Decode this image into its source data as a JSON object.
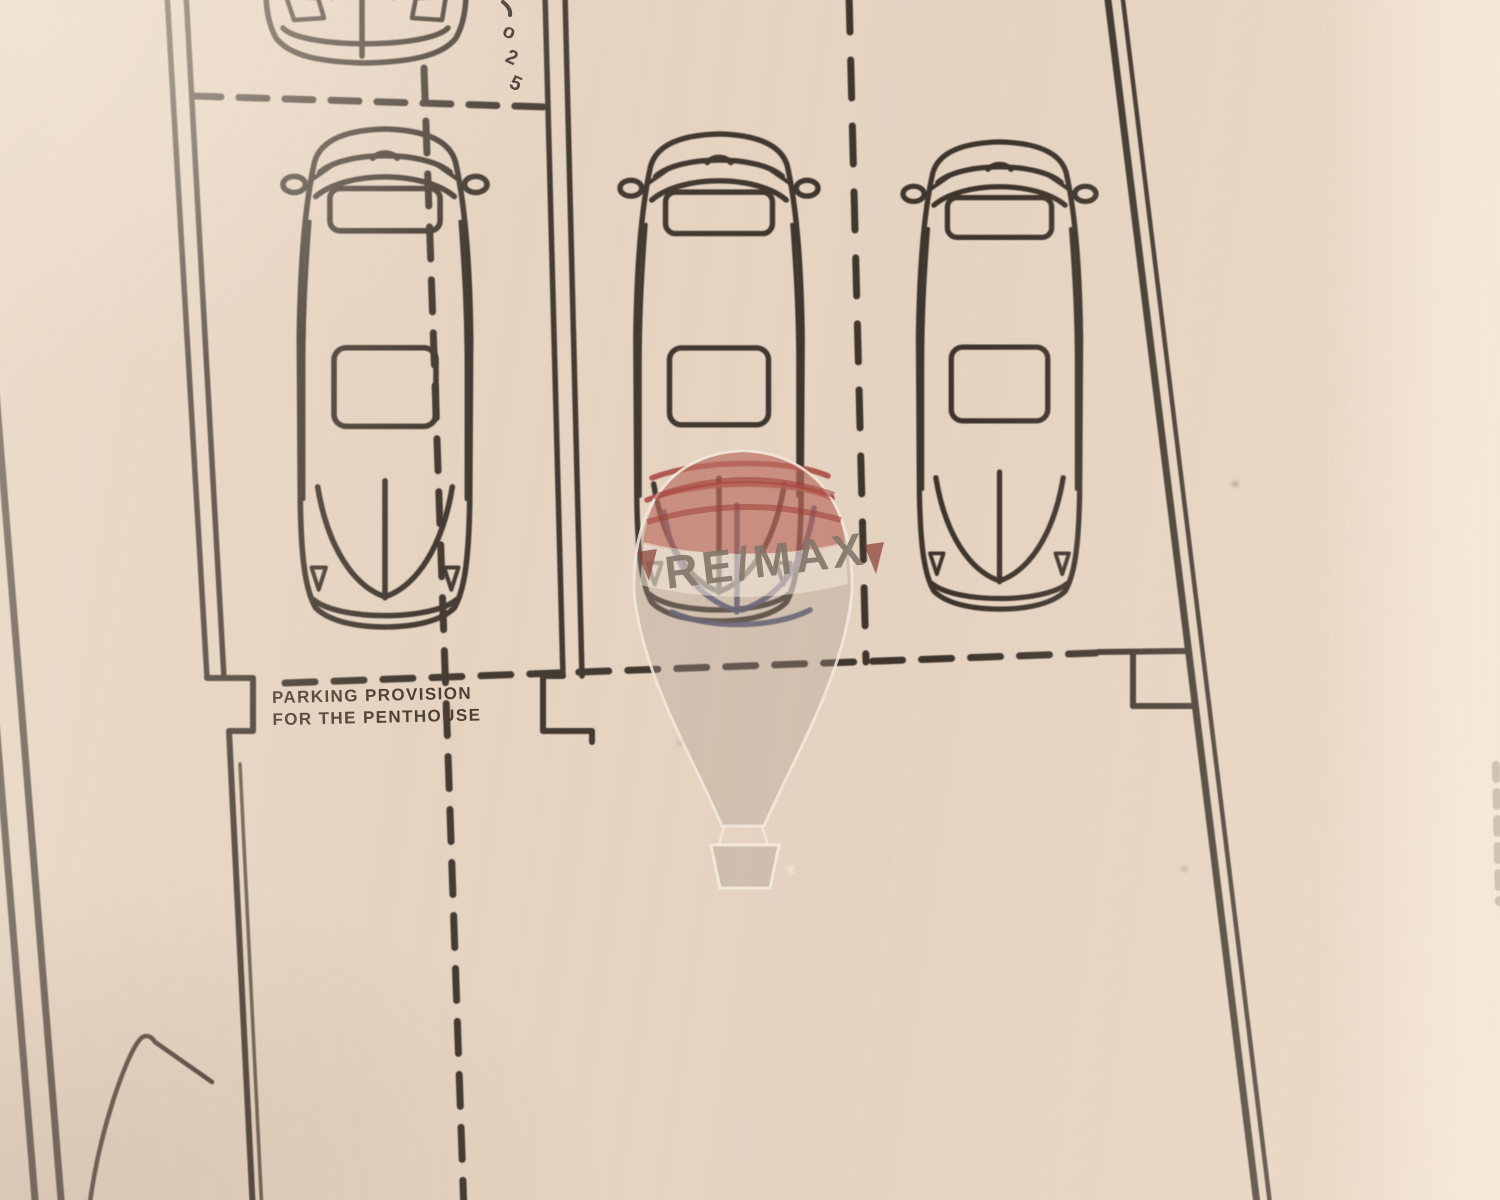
{
  "document": {
    "kind": "scanned architectural parking site plan (photographed drawing)"
  },
  "labels": {
    "parking_note_line1": "PARKING PROVISION",
    "parking_note_line2": "FOR THE PENTHOUSE"
  },
  "vertical_dimension": {
    "chars": [
      "o",
      "2",
      "5"
    ]
  },
  "watermark": {
    "brand": "RE/MAX",
    "registered": "®"
  },
  "plan": {
    "full_cars_shown": 3,
    "partial_cars_shown_top": 1
  },
  "colors": {
    "paper": "#e6d4c2",
    "ink": "#2b231c",
    "watermark_red": "#b84b40",
    "watermark_navy": "#383d63",
    "watermark_gray": "#a89484"
  }
}
